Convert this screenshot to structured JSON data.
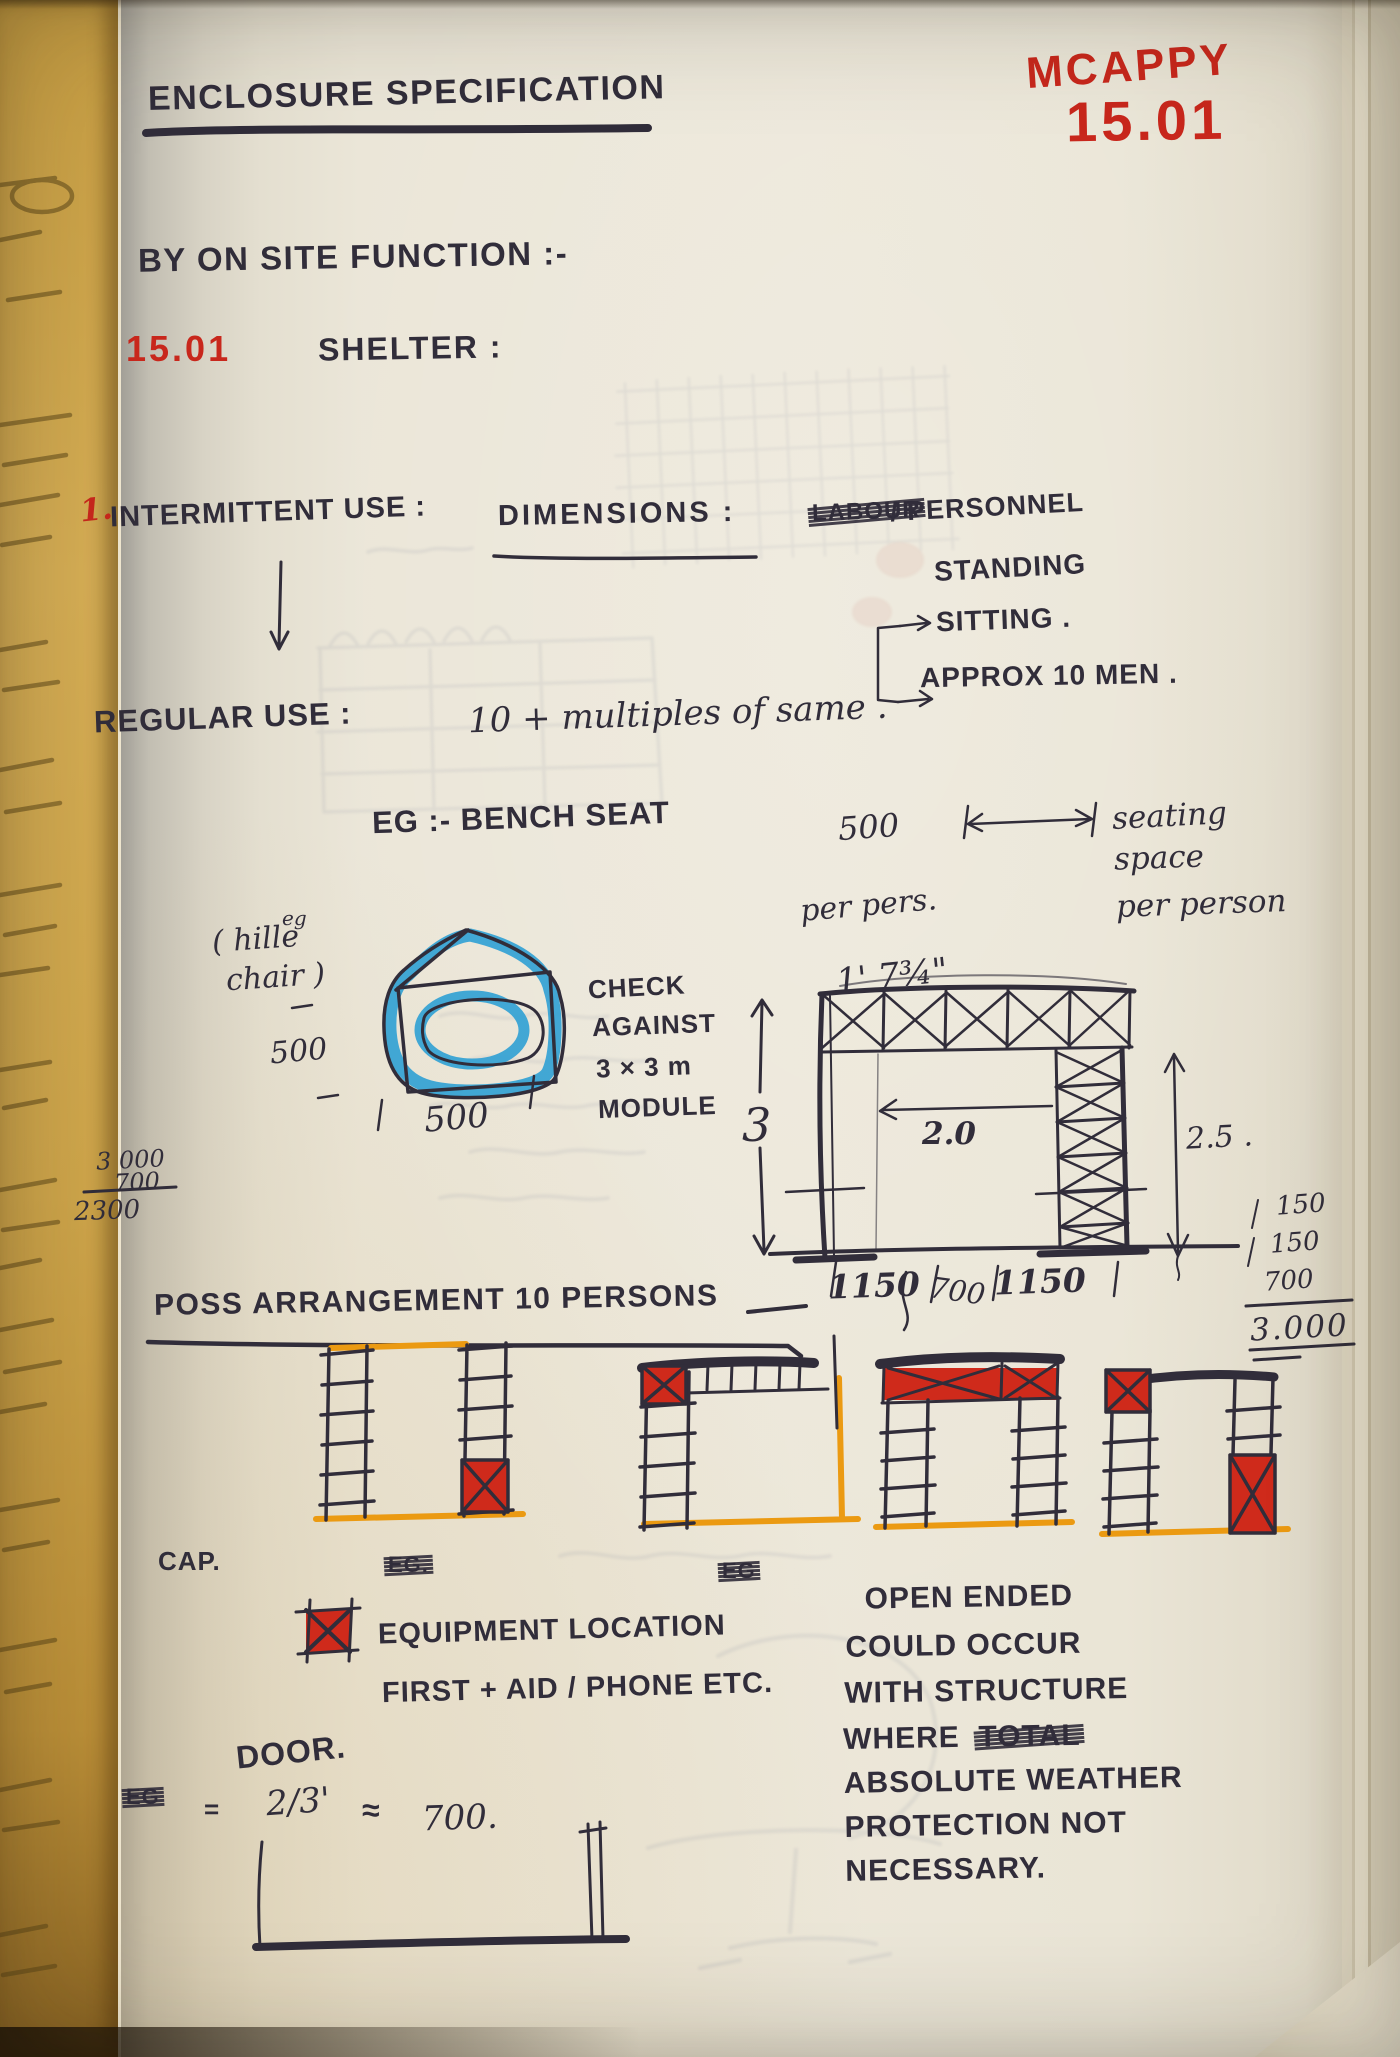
{
  "colors": {
    "ink": "#312d3a",
    "red": "#c8271c",
    "blue_marker": "#2fa0d4",
    "orange_marker": "#eb9a12",
    "paper": "#e9e4d6"
  },
  "header": {
    "title": "ENCLOSURE SPECIFICATION",
    "stamp_name": "MCAPPY",
    "stamp_number": "15.01",
    "subtitle": "BY ON SITE FUNCTION :-",
    "section_number": "15.01",
    "section_label": "SHELTER :"
  },
  "intermittent": {
    "item_number": "1.",
    "label": "INTERMITTENT USE :",
    "dimensions_label": "DIMENSIONS :",
    "crossed_out": "LABOUR",
    "personnel": "/ PERSONNEL",
    "standing": "STANDING",
    "sitting": "SITTING .",
    "approx": "APPROX 10 MEN ."
  },
  "regular": {
    "label": "REGULAR USE :",
    "note": "10 + multiples of same ."
  },
  "bench": {
    "label": "EG :- BENCH SEAT",
    "dim": "500",
    "per_person": "per pers.",
    "imperial": "1' 7¾\"",
    "seating_line1": "seating",
    "seating_line2": "space",
    "seating_line3": "per person"
  },
  "chair": {
    "note_small": "eg",
    "name_line1": "( hille",
    "name_line2": "chair )",
    "dim_side": "500",
    "dim_bottom": "500"
  },
  "margin_sum": {
    "minuend": "3 000",
    "subtrahend": "700",
    "result": "2300"
  },
  "module": {
    "check_line1": "CHECK",
    "check_line2": "AGAINST",
    "check_line3": "3 × 3 m",
    "check_line4": "MODULE",
    "height_label": "3",
    "width_dim": "2.0",
    "height_dim": "2.5 .",
    "dim_left": "1150",
    "dim_mid": "700",
    "dim_right": "1150",
    "sum_1": "150",
    "sum_2": "150",
    "sum_3": "700",
    "sum_total": "3.000"
  },
  "arrangement": {
    "heading": "POSS ARRANGEMENT 10 PERSONS",
    "cap_label": "CAP.",
    "crossed_eg1": "EG.",
    "crossed_eg2": "EG"
  },
  "legend": {
    "equipment_line1": "EQUIPMENT LOCATION",
    "equipment_line2": "FIRST + AID / PHONE ETC.",
    "door_label": "DOOR.",
    "crossed_eg": "EG",
    "eq_equals": "=",
    "eq_fraction": "2/3'",
    "eq_approx": "≈",
    "eq_value": "700."
  },
  "open_ended": {
    "line1": "OPEN ENDED",
    "line2": "COULD OCCUR",
    "line3": "WITH STRUCTURE",
    "line4_pre": "WHERE",
    "line4_crossed": "TOTAL",
    "line5": "ABSOLUTE WEATHER",
    "line6": "PROTECTION NOT",
    "line7": "NECESSARY."
  }
}
